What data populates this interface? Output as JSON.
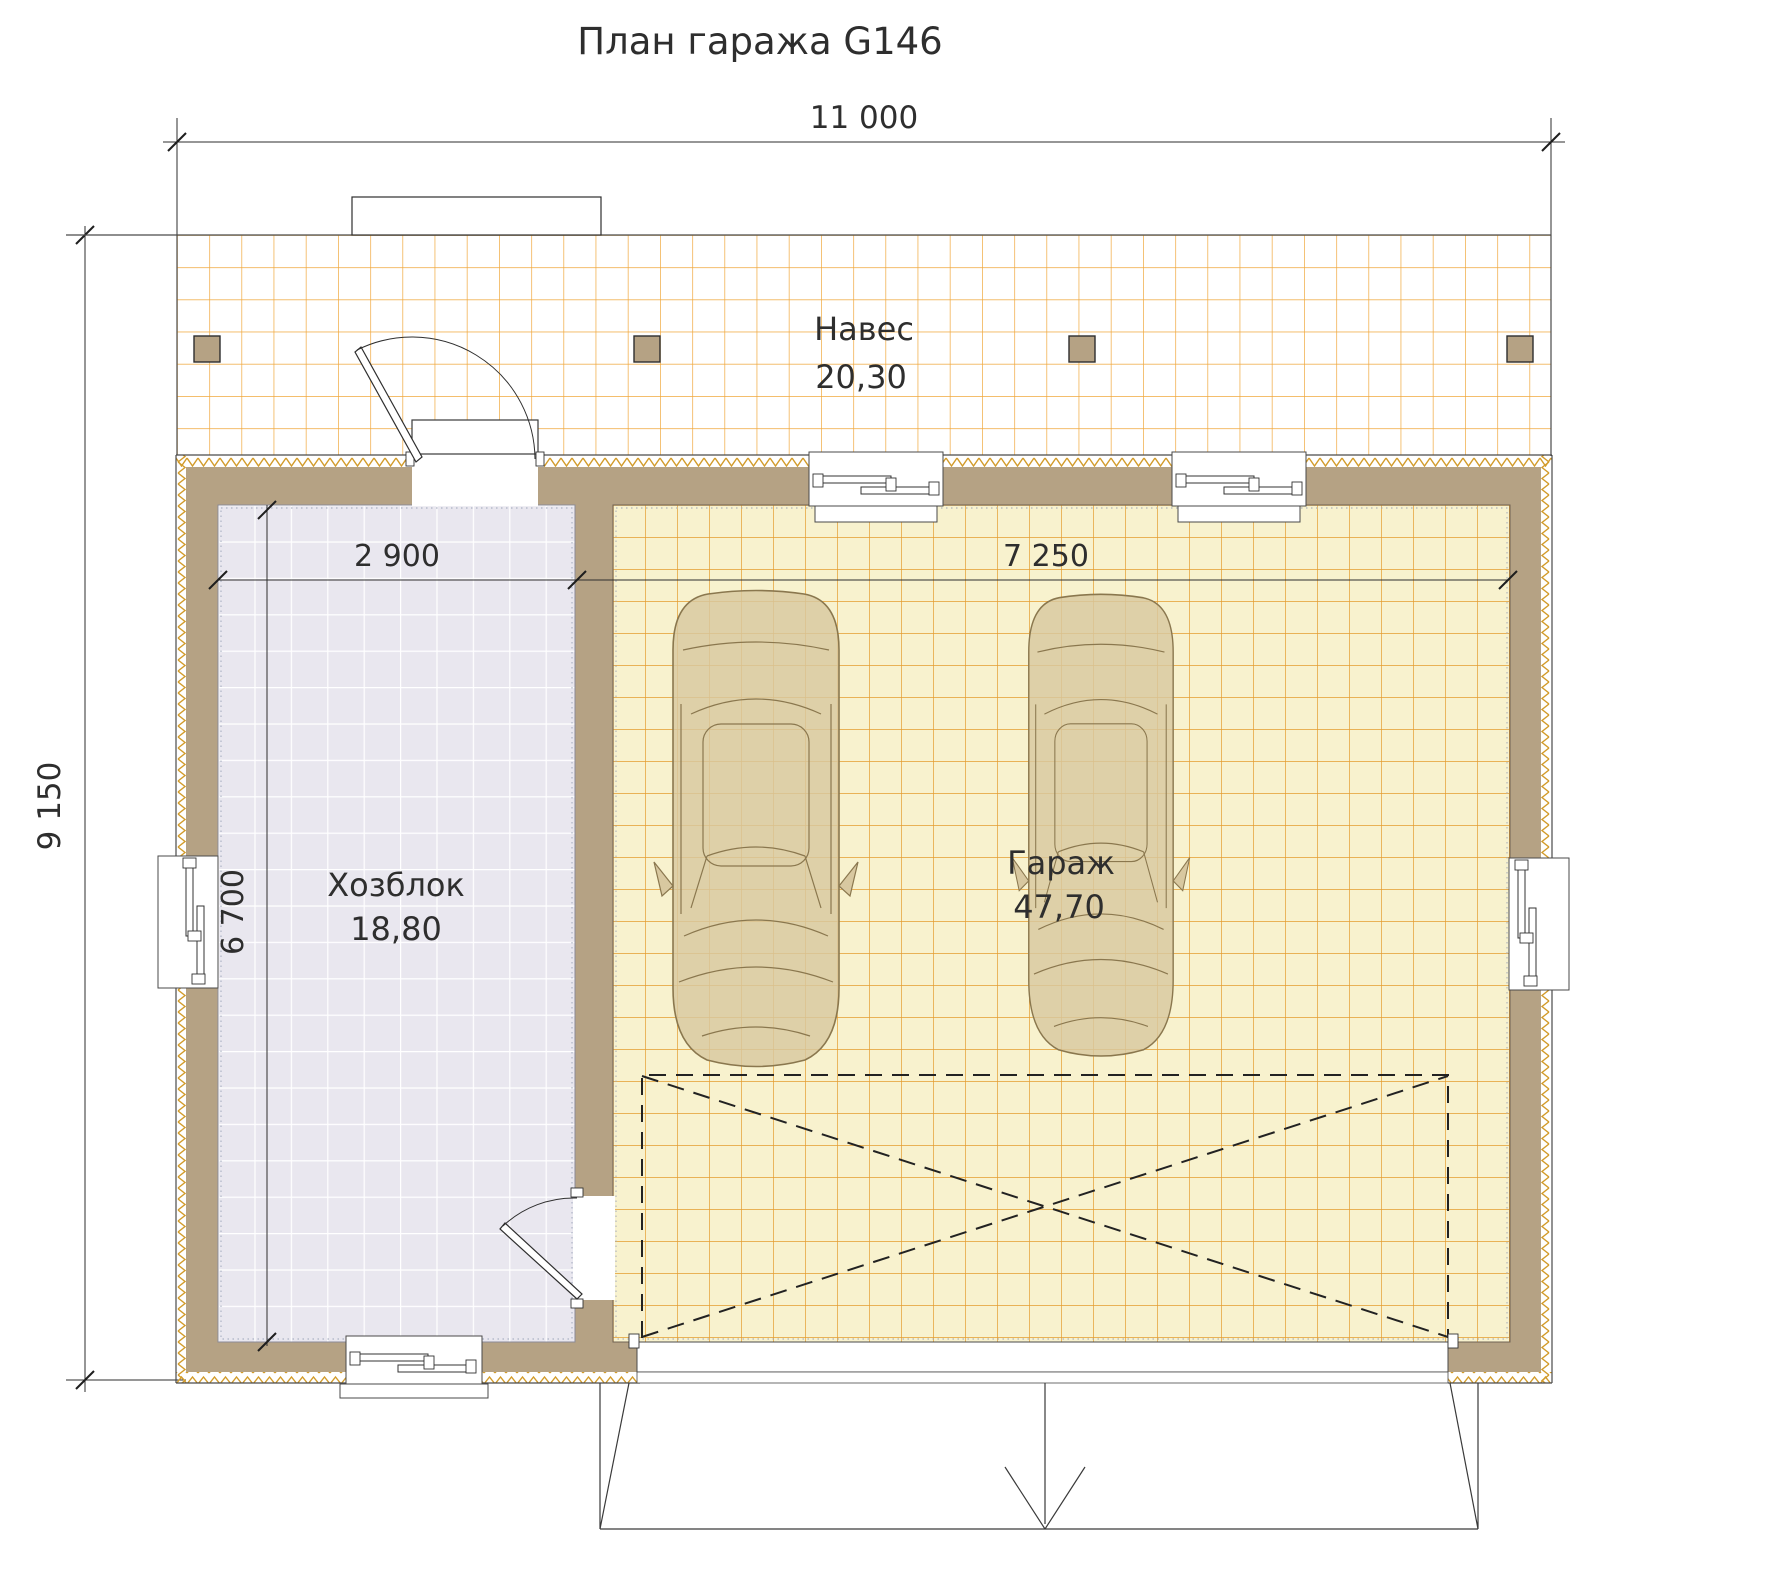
{
  "title": "План гаража G146",
  "dimensions": {
    "overall_width": "11 000",
    "overall_depth": "9 150",
    "utility_width": "2 900",
    "utility_depth": "6 700",
    "garage_width": "7 250"
  },
  "rooms": {
    "canopy": {
      "name": "Навес",
      "area": "20,30"
    },
    "utility": {
      "name": "Хозблок",
      "area": "18,80"
    },
    "garage": {
      "name": "Гараж",
      "area": "47,70"
    }
  },
  "colors": {
    "wall_tan": "#B5A284",
    "canopy_grid": "#F0A73C",
    "garage_grid": "#E49C2F",
    "garage_floor": "#F8F2CE",
    "utility_floor": "#E9E7EF",
    "zigzag_hatch": "#D29B2A",
    "car_body": "#D8C8A0",
    "drawing_line": "#2E2E2E"
  }
}
